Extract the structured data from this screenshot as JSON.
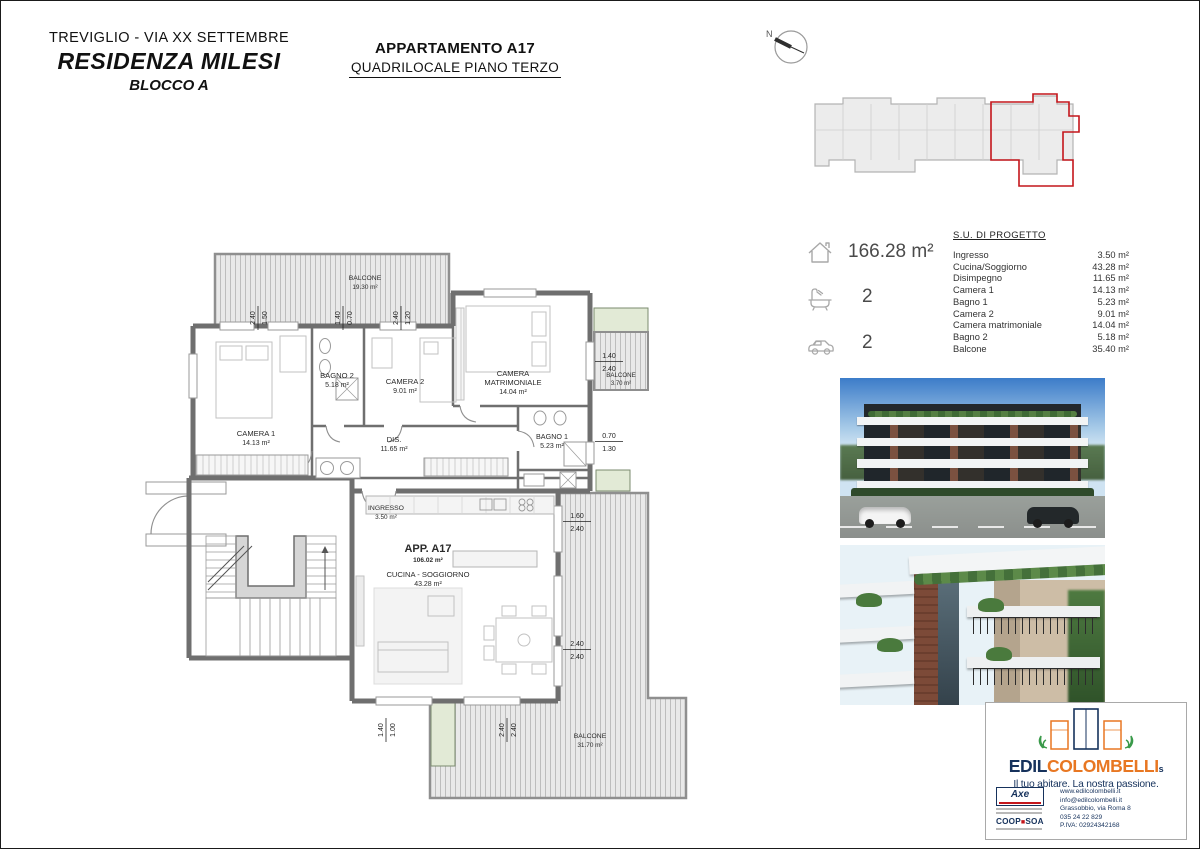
{
  "header": {
    "location": "TREVIGLIO  - VIA XX SETTEMBRE",
    "residence": "RESIDENZA MILESI",
    "block": "BLOCCO A",
    "apartment_title": "APPARTAMENTO A17",
    "apartment_subtitle": "QUADRILOCALE PIANO TERZO"
  },
  "key_plan": {
    "north_label": "N"
  },
  "specs": {
    "area_total": "166.28 m²",
    "bathrooms": "2",
    "parking": "2"
  },
  "su_table": {
    "title": "S.U. DI PROGETTO",
    "rows": [
      {
        "label": "Ingresso",
        "value": "3.50 m²"
      },
      {
        "label": "Cucina/Soggiorno",
        "value": "43.28 m²"
      },
      {
        "label": "Disimpegno",
        "value": "11.65 m²"
      },
      {
        "label": "Camera 1",
        "value": "14.13 m²"
      },
      {
        "label": "Bagno 1",
        "value": "5.23 m²"
      },
      {
        "label": "Camera 2",
        "value": "9.01 m²"
      },
      {
        "label": "Camera matrimoniale",
        "value": "14.04 m²"
      },
      {
        "label": "Bagno 2",
        "value": "5.18 m²"
      },
      {
        "label": "Balcone",
        "value": "35.40 m²"
      }
    ]
  },
  "plan": {
    "apartment_label": "APP. A17",
    "apartment_area": "106.02 m²",
    "rooms": {
      "balcone_top": {
        "name": "BALCONE",
        "area": "19.30 m²"
      },
      "camera1": {
        "name": "CAMERA 1",
        "area": "14.13 m²"
      },
      "bagno2": {
        "name": "BAGNO 2",
        "area": "5.18 m²"
      },
      "camera2": {
        "name": "CAMERA 2",
        "area": "9.01 m²"
      },
      "matr_line1": "CAMERA",
      "matr_line2": "MATRIMONIALE",
      "matr_area": "14.04 m²",
      "bagno1": {
        "name": "BAGNO 1",
        "area": "5.23 m²"
      },
      "dis": {
        "name": "DIS.",
        "area": "11.65 m²"
      },
      "ingresso": {
        "name": "INGRESSO",
        "area": "3.50 m²"
      },
      "cucina": {
        "name": "CUCINA - SOGGIORNO",
        "area": "43.28 m²"
      },
      "balcone_right": {
        "name": "BALCONE",
        "area": "3.70 m²"
      },
      "balcone_bottom": {
        "name": "BALCONE",
        "area": "31.70 m²"
      }
    },
    "dimensions": {
      "top1a": "2.40",
      "top1b": "1.50",
      "top2a": "1.40",
      "top2b": "0.70",
      "top3a": "2.40",
      "top3b": "1.20",
      "right1a": "1.40",
      "right1b": "2.40",
      "right2a": "0.70",
      "right2b": "1.30",
      "right3a": "1.60",
      "right3b": "2.40",
      "right4a": "2.40",
      "right4b": "2.40",
      "bottom1a": "1.40",
      "bottom1b": "1.00",
      "bottom2a": "2.40",
      "bottom2b": "2.40"
    }
  },
  "branding": {
    "brand_edil": "EDIL",
    "brand_colombelli": "COLOMBELLI",
    "brand_suffix": "s",
    "tagline": "Il tuo abitare. La nostra passione.",
    "cert_axe": "Axe",
    "cert_coop": "COOP",
    "cert_coop_sq": "■",
    "cert_soa": "SOA",
    "contact_lines": [
      "www.edilcolombelli.it",
      "info@edilcolombelli.it",
      "Grassobbio, via Roma 8",
      "035 24 22 829",
      "P.IVA: 02924342168"
    ]
  },
  "colors": {
    "accent_red": "#c4161c",
    "brand_navy": "#16325c",
    "brand_orange": "#e87722",
    "wall_gray": "#6f6f6f"
  }
}
